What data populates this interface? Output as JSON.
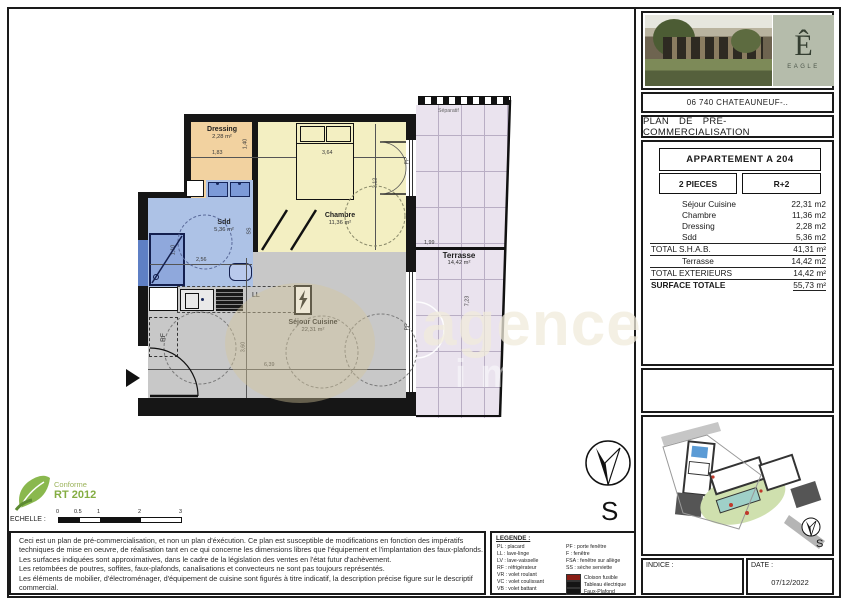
{
  "colors": {
    "dressing": "#f2d2a0",
    "chambre": "#f3efc2",
    "sdd": "#adc2e6",
    "sejour": "#c8c8c8",
    "terrasse": "#eae3ee",
    "legend_red": "#8a1e15",
    "legend_black": "#151515"
  },
  "panel": {
    "address": "06 740 CHATEAUNEUF-..",
    "title": "PLAN  DE  PRE-COMMERCIALISATION",
    "logo": {
      "mark": "Ê",
      "name": "EAGLE"
    },
    "apartment": {
      "name": "APPARTEMENT A 204",
      "pieces": "2 PIECES",
      "level": "R+2"
    },
    "surface_table": {
      "rows": [
        {
          "label": "Séjour Cuisine",
          "value": "22,31  m2"
        },
        {
          "label": "Chambre",
          "value": "11,36  m2"
        },
        {
          "label": "Dressing",
          "value": "2,28  m2"
        },
        {
          "label": "Sdd",
          "value": "5,36  m2"
        },
        {
          "label": "TOTAL S.H.A.B.",
          "value": "41,31  m²"
        },
        {
          "label": "Terrasse",
          "value": "14,42  m2"
        },
        {
          "label": "TOTAL EXTERIEURS",
          "value": "14,42  m²"
        },
        {
          "label": "SURFACE TOTALE",
          "value": "55,73  m²"
        }
      ]
    },
    "footer": {
      "indice_label": "INDICE :",
      "date_label": "DATE :",
      "date_value": "07/12/2022"
    },
    "site_compass": "S"
  },
  "plan": {
    "rooms": [
      {
        "name": "Dressing",
        "area": "2,28 m²"
      },
      {
        "name": "Chambre",
        "area": "11,36 m²"
      },
      {
        "name": "Sdd",
        "area": "5,36 m²"
      },
      {
        "name": "Séjour Cuisine",
        "area": "22,31 m²"
      },
      {
        "name": "Terrasse",
        "area": "14,42 m²"
      }
    ],
    "dimensions": {
      "dressing_width": "1,83",
      "dressing_depth": "1,40",
      "chambre_width": "3,64",
      "chambre_depth": "3,12",
      "sdd_width": "2,56",
      "sdd_depth": "1,10",
      "sejour_width": "6,39",
      "sejour_depth": "3,60",
      "terrasse_width": "1,99",
      "terrasse_depth": "7,23"
    },
    "annotations": {
      "separatif": "Séparatif",
      "ll": "LL",
      "rf": "RF",
      "ss": "SS",
      "pf": "PF",
      "compass": "S"
    }
  },
  "eco_label": {
    "line1": "Conforme",
    "line2": "RT 2012"
  },
  "scale": {
    "label": "ECHELLE :",
    "ticks": [
      "0",
      "0.5",
      "1",
      "2",
      "3"
    ]
  },
  "disclaimer": {
    "lines": [
      "Ceci est un plan de pré-commercialisation, et non un plan d'éxécution. Ce plan est susceptible de modifications en fonction des impératifs",
      "techniques de mise en oeuvre, de réalisation tant en ce qui concerne les dimensions libres que l'équipement et l'implantation des faux-plafonds.",
      "Les surfaces indiquées sont approximatives, dans le cadre de la législation des ventes en l'état futur d'achèvement.",
      "Les retombées de poutres, soffites, faux-plafonds, canalisations et convecteurs ne sont pas toujours représentés.",
      "Les éléments de mobilier, d'électroménager, d'équipement de cuisine sont figurés à titre indicatif, la description précise figure sur le descriptif",
      "commercial."
    ]
  },
  "legend": {
    "title": "LEGENDE :",
    "abbreviations_left": [
      "PL : placard",
      "LL : lave-linge",
      "LV : lave-vaisselle",
      "RF : réfrigérateur",
      "VR : volet roulant",
      "VC : volet coulissant",
      "VB : volet battant"
    ],
    "abbreviations_right": [
      "PF : porte fenêtre",
      "F : fenêtre",
      "FSA : fenêtre sur allège",
      "SS : sèche serviette"
    ],
    "swatches": [
      {
        "color": "#8a1e15",
        "label": "Cloison fusible"
      },
      {
        "color": "#151515",
        "label": "Tableau électrique"
      },
      {
        "color": "#151515",
        "label": "Faux-Plafond"
      }
    ]
  },
  "watermark": {
    "text": "agence",
    "sub": "imm"
  }
}
